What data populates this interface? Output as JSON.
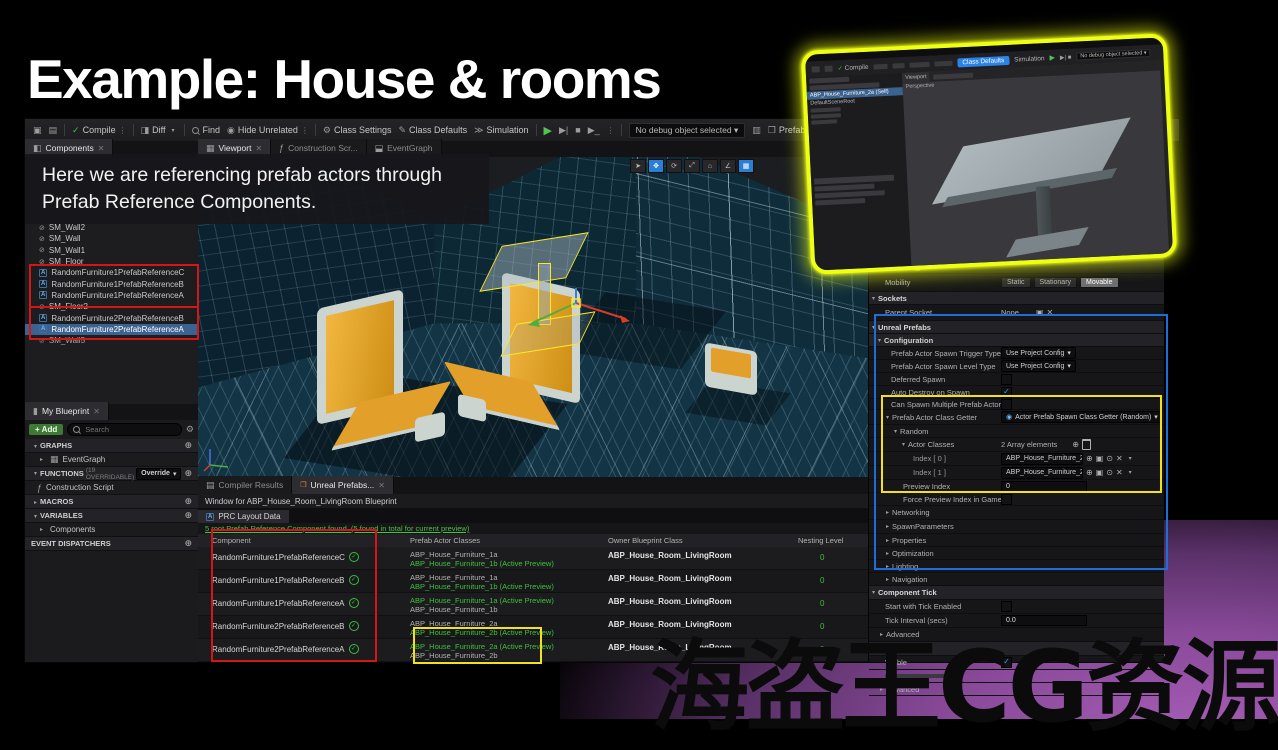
{
  "slide": {
    "title": "Example: House & rooms",
    "caption_line1": "Here we are referencing prefab actors through",
    "caption_line2": "Prefab Reference Components.",
    "watermark": "海盗王CG资源"
  },
  "toolbar": {
    "compile": "Compile",
    "diff": "Diff",
    "find": "Find",
    "hide_unrelated": "Hide Unrelated",
    "class_settings": "Class Settings",
    "class_defaults": "Class Defaults",
    "simulation": "Simulation",
    "no_debug": "No debug object selected",
    "prefab_preview": "Prefab Preview Settings"
  },
  "tabs": {
    "components": "Components",
    "viewport": "Viewport",
    "construction_script": "Construction Scr...",
    "eventgraph": "EventGraph"
  },
  "components_panel": {
    "items": [
      "SM_Wall2",
      "SM_Wall",
      "SM_Wall1",
      "SM_Floor",
      "RandomFurniture1PrefabReferenceC",
      "RandomFurniture1PrefabReferenceB",
      "RandomFurniture1PrefabReferenceA",
      "SM_Floor2",
      "RandomFurniture2PrefabReferenceB",
      "RandomFurniture2PrefabReferenceA",
      "SM_Wall5"
    ]
  },
  "my_blueprint": {
    "tab": "My Blueprint",
    "add": "Add",
    "search_placeholder": "Search",
    "graphs": "GRAPHS",
    "eventgraph": "EventGraph",
    "functions": "FUNCTIONS",
    "functions_note": "(19 OVERRIDABLE)",
    "override": "Override",
    "construction_script": "Construction Script",
    "macros": "MACROS",
    "variables": "VARIABLES",
    "components": "Components",
    "event_dispatchers": "EVENT DISPATCHERS"
  },
  "bottom_panel": {
    "tab_compiler": "Compiler Results",
    "tab_prefabs": "Unreal Prefabs...",
    "window_label": "Window for ABP_House_Room_LivingRoom Blueprint",
    "sub_tab": "PRC Layout Data",
    "status": "5 root Prefab Reference Component found. (5 found in total for current preview)",
    "headers": [
      "Component",
      "Prefab Actor Classes",
      "Owner Blueprint Class",
      "Nesting Level"
    ],
    "rows": [
      {
        "component": "RandomFurniture1PrefabReferenceC",
        "class1": "ABP_House_Furniture_1a",
        "class2": "ABP_House_Furniture_1b (Active Preview)",
        "owner": "ABP_House_Room_LivingRoom",
        "nesting": "0"
      },
      {
        "component": "RandomFurniture1PrefabReferenceB",
        "class1": "ABP_House_Furniture_1a",
        "class2": "ABP_House_Furniture_1b (Active Preview)",
        "owner": "ABP_House_Room_LivingRoom",
        "nesting": "0"
      },
      {
        "component": "RandomFurniture1PrefabReferenceA",
        "class1": "ABP_House_Furniture_1a (Active Preview)",
        "class2": "ABP_House_Furniture_1b",
        "owner": "ABP_House_Room_LivingRoom",
        "nesting": "0"
      },
      {
        "component": "RandomFurniture2PrefabReferenceB",
        "class1": "ABP_House_Furniture_2a",
        "class2": "ABP_House_Furniture_2b (Active Preview)",
        "owner": "ABP_House_Room_LivingRoom",
        "nesting": "0"
      },
      {
        "component": "RandomFurniture2PrefabReferenceA",
        "class1": "ABP_House_Furniture_2a (Active Preview)",
        "class2": "ABP_House_Furniture_2b",
        "owner": "ABP_House_Room_LivingRoom",
        "nesting": "0"
      }
    ]
  },
  "details": {
    "scale": "Scale",
    "mobility": "Mobility",
    "mobility_options": [
      "Static",
      "Stationary",
      "Movable"
    ],
    "sockets": "Sockets",
    "parent_socket": "Parent Socket",
    "parent_socket_value": "None",
    "unreal_prefabs": "Unreal Prefabs",
    "configuration": "Configuration",
    "spawn_trigger_label": "Prefab Actor Spawn Trigger Type",
    "spawn_trigger_value": "Use Project Config",
    "spawn_level_label": "Prefab Actor Spawn Level Type",
    "spawn_level_value": "Use Project Config",
    "deferred_spawn": "Deferred Spawn",
    "auto_destroy": "Auto Destroy on Spawn",
    "can_spawn_multiple": "Can Spawn Multiple Prefab Actors",
    "class_getter_label": "Prefab Actor Class Getter",
    "class_getter_value": "Actor Prefab Spawn Class Getter (Random)",
    "random": "Random",
    "actor_classes": "Actor Classes",
    "array_elements": "2 Array elements",
    "index0_label": "Index [ 0 ]",
    "index0_value": "ABP_House_Furniture_2a",
    "index1_label": "Index [ 1 ]",
    "index1_value": "ABP_House_Furniture_2b",
    "preview_index": "Preview Index",
    "preview_index_value": "0",
    "force_preview": "Force Preview Index in Game",
    "networking": "Networking",
    "spawn_parameters": "SpawnParameters",
    "properties": "Properties",
    "optimization": "Optimization",
    "lighting": "Lighting",
    "navigation": "Navigation",
    "component_tick": "Component Tick",
    "tick_enabled": "Start with Tick Enabled",
    "tick_interval": "Tick Interval (secs)",
    "tick_interval_value": "0.0",
    "advanced": "Advanced",
    "rendering": "Rendering",
    "visible": "Visible"
  },
  "inset": {
    "compile": "Compile",
    "class_defaults": "Class Defaults",
    "simulation": "Simulation",
    "no_debug": "No debug object selected",
    "viewport_tab": "Viewport",
    "perspective": "Perspective",
    "selected_component": "ABP_House_Furniture_2a (Self)",
    "scene_root": "DefaultSceneRoot"
  }
}
